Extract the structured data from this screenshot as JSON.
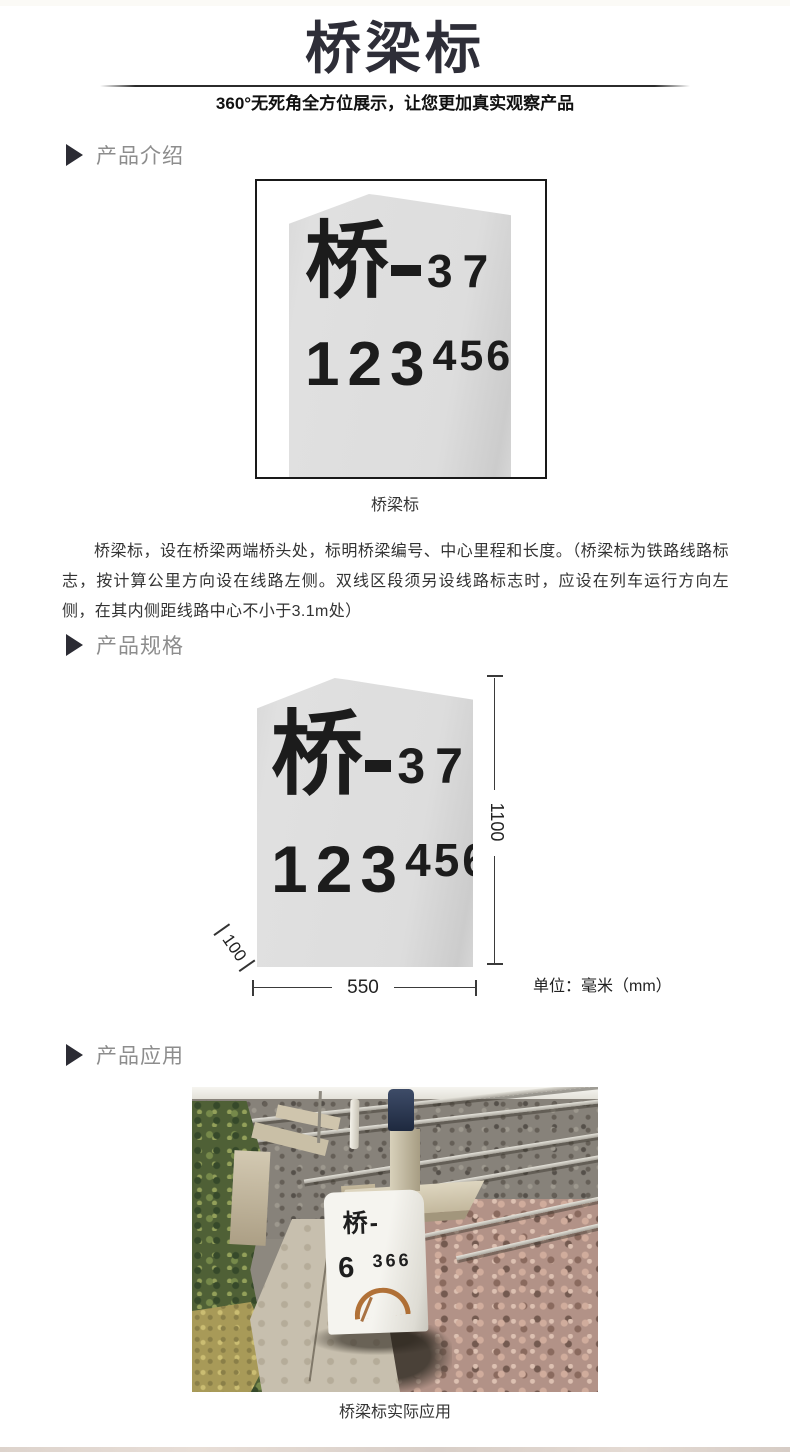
{
  "header": {
    "title": "桥梁标",
    "subtitle": "360°无死角全方位展示，让您更加真实观察产品"
  },
  "sections": {
    "intro_label": "产品介绍",
    "spec_label": "产品规格",
    "app_label": "产品应用"
  },
  "marker_face": {
    "bridge_char": "桥",
    "dash": "—",
    "bridge_no": "37",
    "mileage_main": "123",
    "mileage_sup": "456"
  },
  "intro": {
    "caption": "桥梁标",
    "description": "桥梁标，设在桥梁两端桥头处，标明桥梁编号、中心里程和长度。（桥梁标为铁路线路标志，按计算公里方向设在线路左侧。双线区段须另设线路标志时，应设在列车运行方向左侧，在其内侧距线路中心不小于3.1m处）"
  },
  "spec": {
    "height_label": "1100",
    "width_label": "550",
    "depth_label": "100",
    "unit": "单位：毫米（mm）"
  },
  "application": {
    "caption": "桥梁标实际应用",
    "stone_line1": "桥-",
    "stone_big": "6",
    "stone_small": "366"
  },
  "colors": {
    "title": "#2e2e38",
    "section_label": "#8d8d8d",
    "stone_fill": "#dcdcdc",
    "body_text": "#333333",
    "rust": "#a85f1e"
  }
}
